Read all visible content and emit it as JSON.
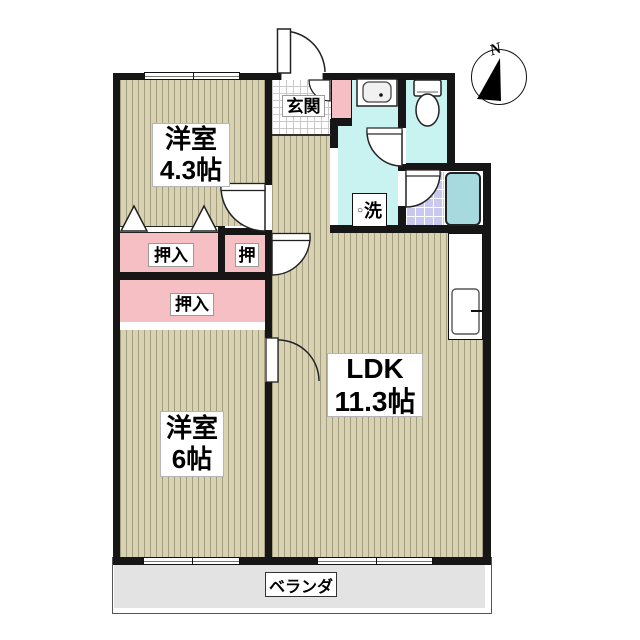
{
  "floorplan": {
    "compass": {
      "label": "N"
    },
    "rooms": {
      "western_room_small": {
        "name": "洋室",
        "size": "4.3帖"
      },
      "western_room_large": {
        "name": "洋室",
        "size": "6帖"
      },
      "ldk": {
        "name": "LDK",
        "size": "11.3帖"
      },
      "entrance": {
        "label": "玄関"
      },
      "laundry_spot": {
        "marker": "○",
        "label": "洗"
      },
      "closet_top": {
        "label": "押入"
      },
      "closet_small": {
        "label": "押"
      },
      "closet_bottom": {
        "label": "押入"
      },
      "veranda": {
        "label": "ベランダ"
      }
    },
    "colors": {
      "wood_floor": "#d8d2b2",
      "wood_stripe": "#a49e80",
      "closet_pink": "#f5bfc3",
      "wet_area_cyan": "#c9f3f1",
      "bath_tile_purple": "#c9c9f0",
      "bathtub_blue": "#a6dade",
      "veranda_gray": "#e3e3e3",
      "wall_black": "#161616"
    }
  }
}
